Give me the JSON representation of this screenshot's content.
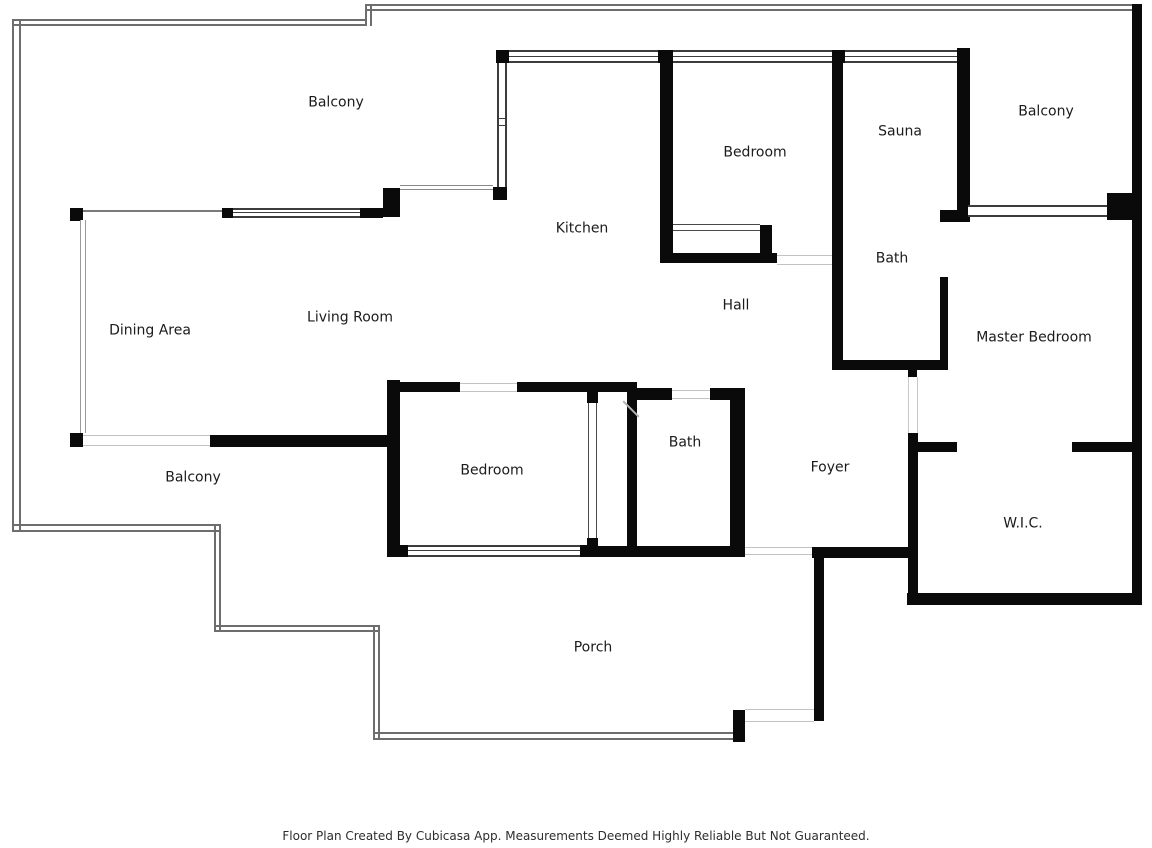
{
  "floorplan": {
    "rooms": [
      {
        "id": "balcony-top-left",
        "label": "Balcony"
      },
      {
        "id": "kitchen",
        "label": "Kitchen"
      },
      {
        "id": "bedroom-top",
        "label": "Bedroom"
      },
      {
        "id": "sauna",
        "label": "Sauna"
      },
      {
        "id": "balcony-top-right",
        "label": "Balcony"
      },
      {
        "id": "bath-upper",
        "label": "Bath"
      },
      {
        "id": "master-bedroom",
        "label": "Master Bedroom"
      },
      {
        "id": "dining-area",
        "label": "Dining Area"
      },
      {
        "id": "living-room",
        "label": "Living Room"
      },
      {
        "id": "hall",
        "label": "Hall"
      },
      {
        "id": "bedroom-middle",
        "label": "Bedroom"
      },
      {
        "id": "bath-lower",
        "label": "Bath"
      },
      {
        "id": "foyer",
        "label": "Foyer"
      },
      {
        "id": "wic",
        "label": "W.I.C."
      },
      {
        "id": "balcony-bottom",
        "label": "Balcony"
      },
      {
        "id": "porch",
        "label": "Porch"
      }
    ],
    "footer": "Floor Plan Created By Cubicasa App. Measurements Deemed Highly Reliable But Not Guaranteed.",
    "colors": {
      "wall": "#0a0a0a",
      "window_line": "#3c3c3c",
      "boundary_line": "#6d6d6d",
      "label_text": "#1b1b1b",
      "background": "#ffffff"
    }
  }
}
